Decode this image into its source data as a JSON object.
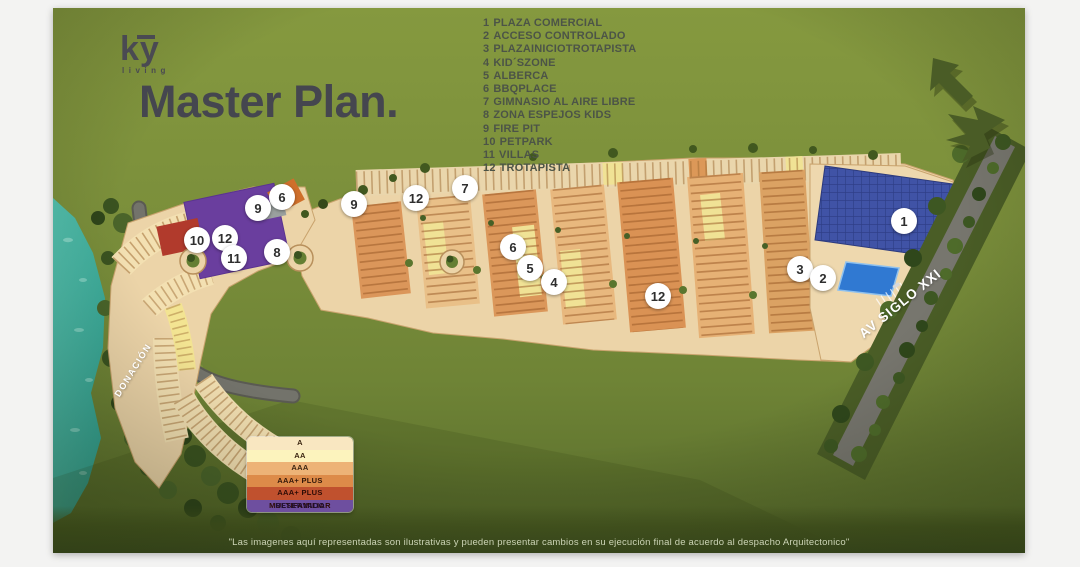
{
  "logo": {
    "text": "ky",
    "subtext": "living"
  },
  "title": "Master Plan.",
  "amenities": {
    "items": [
      {
        "num": "1",
        "label": "PLAZA COMERCIAL"
      },
      {
        "num": "2",
        "label": "ACCESO CONTROLADO"
      },
      {
        "num": "3",
        "label": "PLAZAINICIOTROTAPISTA"
      },
      {
        "num": "4",
        "label": "KID´SZONE"
      },
      {
        "num": "5",
        "label": "ALBERCA"
      },
      {
        "num": "6",
        "label": "BBQPLACE"
      },
      {
        "num": "7",
        "label": "GIMNASIO AL AIRE LIBRE"
      },
      {
        "num": "8",
        "label": "ZONA ESPEJOS KIDS"
      },
      {
        "num": "9",
        "label": "FIRE PIT"
      },
      {
        "num": "10",
        "label": "PETPARK"
      },
      {
        "num": "11",
        "label": "VILLAS"
      },
      {
        "num": "12",
        "label": "TROTAPISTA"
      }
    ]
  },
  "legend": {
    "rows": [
      {
        "label": "A",
        "color": "#f9e7c1",
        "text_color": "#3a2410"
      },
      {
        "label": "AA",
        "color": "#fcf3bd",
        "text_color": "#3a2410"
      },
      {
        "label": "AAA",
        "color": "#edb377",
        "text_color": "#3a2410"
      },
      {
        "label": "AAA+ PLUS",
        "color": "#dd8b49",
        "text_color": "#33180a"
      },
      {
        "label": "AAA+ PLUS MULTIFAMILIAR",
        "color": "#c0512e",
        "text_color": "#2d0c06"
      },
      {
        "label": "RESERVADO",
        "color": "#6e4f9f",
        "text_color": "#201034"
      }
    ]
  },
  "map": {
    "labels": {
      "road_left": "DONACIÓN",
      "avenue": "AV SIGLO XXI"
    },
    "markers": [
      {
        "label": "6",
        "x": 229,
        "y": 189
      },
      {
        "label": "9",
        "x": 205,
        "y": 200
      },
      {
        "label": "10",
        "x": 144,
        "y": 232
      },
      {
        "label": "12",
        "x": 172,
        "y": 230
      },
      {
        "label": "11",
        "x": 181,
        "y": 250
      },
      {
        "label": "8",
        "x": 224,
        "y": 244
      },
      {
        "label": "9",
        "x": 301,
        "y": 196
      },
      {
        "label": "12",
        "x": 363,
        "y": 190
      },
      {
        "label": "7",
        "x": 412,
        "y": 180
      },
      {
        "label": "6",
        "x": 460,
        "y": 239
      },
      {
        "label": "5",
        "x": 477,
        "y": 260
      },
      {
        "label": "4",
        "x": 501,
        "y": 274
      },
      {
        "label": "12",
        "x": 605,
        "y": 288
      },
      {
        "label": "3",
        "x": 747,
        "y": 261
      },
      {
        "label": "2",
        "x": 770,
        "y": 270
      },
      {
        "label": "1",
        "x": 851,
        "y": 213
      }
    ]
  },
  "disclaimer": "\"Las imagenes aquí representadas son ilustrativas y pueden presentar cambios en su ejecución final de acuerdo al despacho Arquitectonico\"",
  "colors": {
    "background_green": "#7b8f3b",
    "dark_band_green": "#4c5e24",
    "forest_green": "#3a5320",
    "water_teal": "#3fb1a0",
    "road_beige": "#ecd4a8",
    "road_gray": "#72726a",
    "block_orange": "#db965a",
    "block_tan": "#e9c088",
    "block_yellow": "#f0e295",
    "multifamiliar_purple": "#6a3e9e",
    "reserved_red": "#b13a2c",
    "solar_panel_blue": "#4053a6",
    "pool_blue": "#3079d2",
    "text_dark": "#45464f",
    "list_text": "#4c5447"
  }
}
